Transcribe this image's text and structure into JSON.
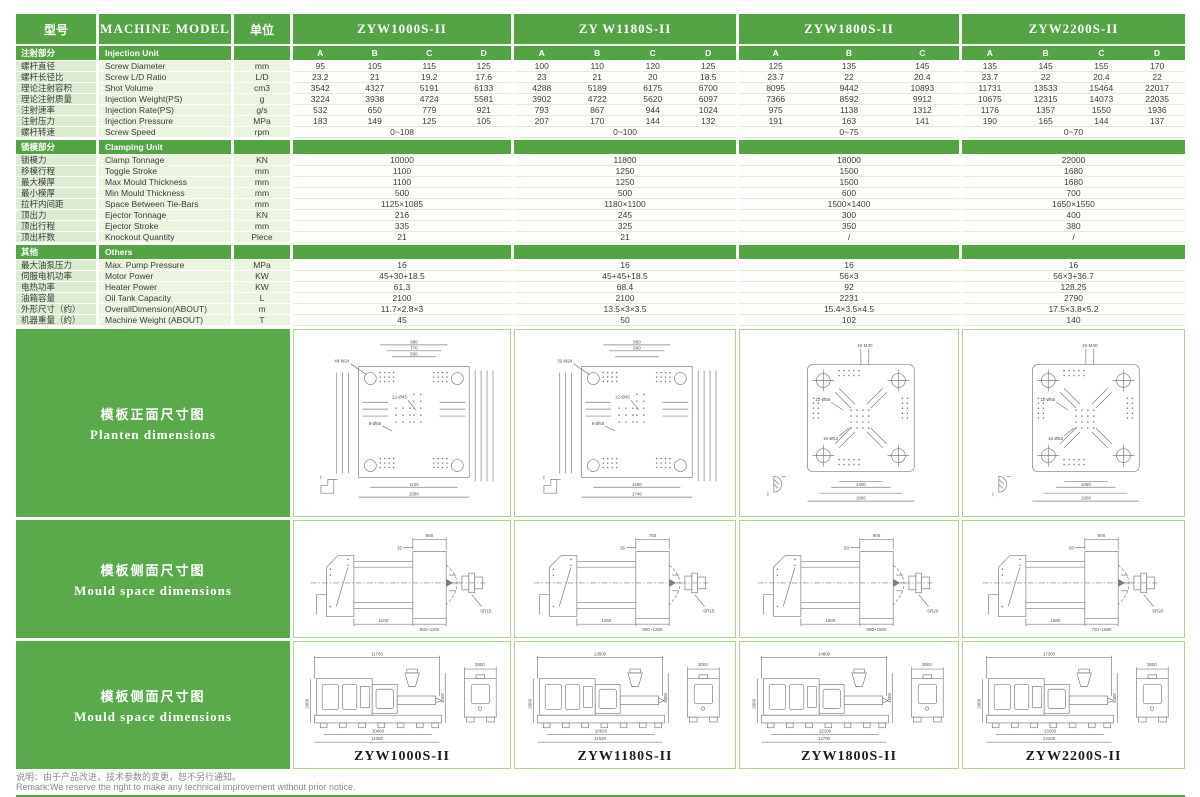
{
  "header": {
    "model_zh": "型号",
    "model_en": "MACHINE  MODEL",
    "unit": "单位",
    "machines": [
      {
        "name": "ZYW1000S-II",
        "subs": [
          "A",
          "B",
          "C",
          "D"
        ]
      },
      {
        "name": "ZY W1180S-II",
        "subs": [
          "A",
          "B",
          "C",
          "D"
        ]
      },
      {
        "name": "ZYW1800S-II",
        "subs": [
          "A",
          "B",
          "C"
        ]
      },
      {
        "name": "ZYW2200S-II",
        "subs": [
          "A",
          "B",
          "C",
          "D"
        ]
      }
    ]
  },
  "sections": [
    {
      "zh": "注射部分",
      "en": "Injection Unit",
      "show_subs": true,
      "rows": [
        {
          "zh": "螺杆直径",
          "en": "Screw Diameter",
          "unit": "mm",
          "vals": [
            [
              "95",
              "105",
              "115",
              "125"
            ],
            [
              "100",
              "110",
              "120",
              "125"
            ],
            [
              "125",
              "135",
              "145"
            ],
            [
              "135",
              "145",
              "155",
              "170"
            ]
          ]
        },
        {
          "zh": "螺杆长径比",
          "en": "Screw L/D Ratio",
          "unit": "L/D",
          "vals": [
            [
              "23.2",
              "21",
              "19.2",
              "17.6"
            ],
            [
              "23",
              "21",
              "20",
              "18.5"
            ],
            [
              "23.7",
              "22",
              "20.4"
            ],
            [
              "23.7",
              "22",
              "20.4",
              "22"
            ]
          ]
        },
        {
          "zh": "理论注射容积",
          "en": "Shot Volume",
          "unit": "cm3",
          "vals": [
            [
              "3542",
              "4327",
              "5191",
              "6133"
            ],
            [
              "4288",
              "5189",
              "6175",
              "6700"
            ],
            [
              "8095",
              "9442",
              "10893"
            ],
            [
              "11731",
              "13533",
              "15464",
              "22017"
            ]
          ]
        },
        {
          "zh": "理论注射质量",
          "en": "Injection Weight(PS)",
          "unit": "g",
          "vals": [
            [
              "3224",
              "3938",
              "4724",
              "5581"
            ],
            [
              "3902",
              "4722",
              "5620",
              "6097"
            ],
            [
              "7366",
              "8592",
              "9912"
            ],
            [
              "10675",
              "12315",
              "14073",
              "22035"
            ]
          ]
        },
        {
          "zh": "注射速率",
          "en": "Injection Rate(PS)",
          "unit": "g/s",
          "vals": [
            [
              "532",
              "650",
              "779",
              "921"
            ],
            [
              "793",
              "867",
              "944",
              "1024"
            ],
            [
              "975",
              "1138",
              "1312"
            ],
            [
              "1176",
              "1357",
              "1550",
              "1936"
            ]
          ]
        },
        {
          "zh": "注射压力",
          "en": "Injection Pressure",
          "unit": "MPa",
          "vals": [
            [
              "183",
              "149",
              "125",
              "105"
            ],
            [
              "207",
              "170",
              "144",
              "132"
            ],
            [
              "191",
              "163",
              "141"
            ],
            [
              "190",
              "165",
              "144",
              "137"
            ]
          ]
        },
        {
          "zh": "螺杆转速",
          "en": "Screw Speed",
          "unit": "rpm",
          "span": true,
          "vals": [
            "0~108",
            "0~100",
            "0~75",
            "0~70"
          ]
        }
      ]
    },
    {
      "zh": "锁模部分",
      "en": "Clamping Unit",
      "show_subs": false,
      "rows": [
        {
          "zh": "锁模力",
          "en": "Clamp Tonnage",
          "unit": "KN",
          "span": true,
          "vals": [
            "10000",
            "11800",
            "18000",
            "22000"
          ]
        },
        {
          "zh": "移模行程",
          "en": "Toggle Stroke",
          "unit": "mm",
          "span": true,
          "vals": [
            "1100",
            "1250",
            "1500",
            "1680"
          ]
        },
        {
          "zh": "最大模厚",
          "en": "Max  Mould Thickness",
          "unit": "mm",
          "span": true,
          "vals": [
            "1100",
            "1250",
            "1500",
            "1680"
          ]
        },
        {
          "zh": "最小模厚",
          "en": "Min  Mould Thickness",
          "unit": "mm",
          "span": true,
          "vals": [
            "500",
            "500",
            "600",
            "700"
          ]
        },
        {
          "zh": "拉杆内间距",
          "en": "Space Between Tie-Bars",
          "unit": "mm",
          "span": true,
          "vals": [
            "1125×1085",
            "1180×1100",
            "1500×1400",
            "1650×1550"
          ]
        },
        {
          "zh": "顶出力",
          "en": "Ejector Tonnage",
          "unit": "KN",
          "span": true,
          "vals": [
            "216",
            "245",
            "300",
            "400"
          ]
        },
        {
          "zh": "顶出行程",
          "en": "Ejector Stroke",
          "unit": "mm",
          "span": true,
          "vals": [
            "335",
            "325",
            "350",
            "380"
          ]
        },
        {
          "zh": "顶出杆数",
          "en": "Knockout Quantity",
          "unit": "Piece",
          "span": true,
          "vals": [
            "21",
            "21",
            "/",
            "/"
          ]
        }
      ]
    },
    {
      "zh": "其他",
      "en": "Others",
      "show_subs": false,
      "rows": [
        {
          "zh": "最大油泵压力",
          "en": "Max. Pump Pressure",
          "unit": "MPa",
          "span": true,
          "vals": [
            "16",
            "16",
            "16",
            "16"
          ]
        },
        {
          "zh": "伺服电机功率",
          "en": "Motor Power",
          "unit": "KW",
          "span": true,
          "vals": [
            "45+30+18.5",
            "45+45+18.5",
            "56×3",
            "56×3+36.7"
          ]
        },
        {
          "zh": "电热功率",
          "en": "Heater Power",
          "unit": "KW",
          "span": true,
          "vals": [
            "61.3",
            "68.4",
            "92",
            "128.25"
          ]
        },
        {
          "zh": "油箱容量",
          "en": "Oil Tank Capacity",
          "unit": "L",
          "span": true,
          "vals": [
            "2100",
            "2100",
            "2231",
            "2790"
          ]
        },
        {
          "zh": "外形尺寸（约）",
          "en": "OverallDimension(ABOUT)",
          "unit": "m",
          "span": true,
          "vals": [
            "11.7×2.8×3",
            "13.5×3×3.5",
            "15.4×3.5×4.5",
            "17.5×3.8×5.2"
          ]
        },
        {
          "zh": "机器重量（约）",
          "en": "Machine Weight (ABOUT)",
          "unit": "T",
          "span": true,
          "vals": [
            "45",
            "50",
            "102",
            "140"
          ]
        }
      ]
    }
  ],
  "drawings": {
    "row1_label": {
      "zh": "模板正面尺寸图",
      "en": "Planten  dimensions"
    },
    "row2_label": {
      "zh": "模板侧面尺寸图",
      "en": "Mould  space  dimensions"
    },
    "row3_label": {
      "zh": "模板侧面尺寸图",
      "en": "Mould  space  dimensions"
    },
    "platen": [
      {
        "style": "slots",
        "top_dims": [
          "980",
          "770",
          "560"
        ],
        "callouts": [
          "48-M24",
          "12-Ø45",
          "8-Ø55"
        ],
        "bottom_dims": [
          "1125",
          "1580"
        ]
      },
      {
        "style": "slots",
        "top_dims": [
          "860",
          "560",
          ""
        ],
        "callouts": [
          "32-M24",
          "12-Ø45",
          "8-Ø55"
        ],
        "bottom_dims": [
          "1180",
          "1740"
        ]
      },
      {
        "style": "cross",
        "top_dims": [
          "",
          "",
          ""
        ],
        "callouts": [
          "40-M30",
          "12-Ø55",
          "16-Ø52"
        ],
        "bottom_dims": [
          "1400",
          "1600"
        ]
      },
      {
        "style": "cross",
        "top_dims": [
          "",
          "",
          ""
        ],
        "callouts": [
          "40-M30",
          "12-Ø55",
          "16-Ø52"
        ],
        "bottom_dims": [
          "1650",
          "1900"
        ]
      }
    ],
    "mould_space": [
      {
        "top": "680",
        "offset": "35",
        "nozzle": "SR15",
        "bottom1": "1100",
        "bottom2": "500~1100"
      },
      {
        "top": "750",
        "offset": "35",
        "nozzle": "SR15",
        "bottom1": "1250",
        "bottom2": "500~1250"
      },
      {
        "top": "900",
        "offset": "50",
        "nozzle": "SR20",
        "bottom1": "1500",
        "bottom2": "600~1500"
      },
      {
        "top": "900",
        "offset": "50",
        "nozzle": "SR20",
        "bottom1": "1680",
        "bottom2": "700~1680"
      }
    ],
    "elevation": [
      {
        "top": "11700",
        "end": "2800",
        "height": "3000",
        "bottom1": "10400",
        "bottom2": "11000",
        "name": "ZYW1000S-II"
      },
      {
        "top": "13500",
        "end": "3000",
        "height": "3500",
        "bottom1": "10920",
        "bottom2": "11620",
        "name": "ZYW1180S-II"
      },
      {
        "top": "14800",
        "end": "3500",
        "height": "4500",
        "bottom1": "12100",
        "bottom2": "12700",
        "name": "ZYW1800S-II"
      },
      {
        "top": "17300",
        "end": "3800",
        "height": "5200",
        "bottom1": "13200",
        "bottom2": "14100",
        "name": "ZYW2200S-II"
      }
    ]
  },
  "footer": {
    "line1": "说明：由于产品改进，技术参数的变更，恕不另行通知。",
    "line2": "Remark:We reserve the right to make any technical improvement without prior notice."
  }
}
